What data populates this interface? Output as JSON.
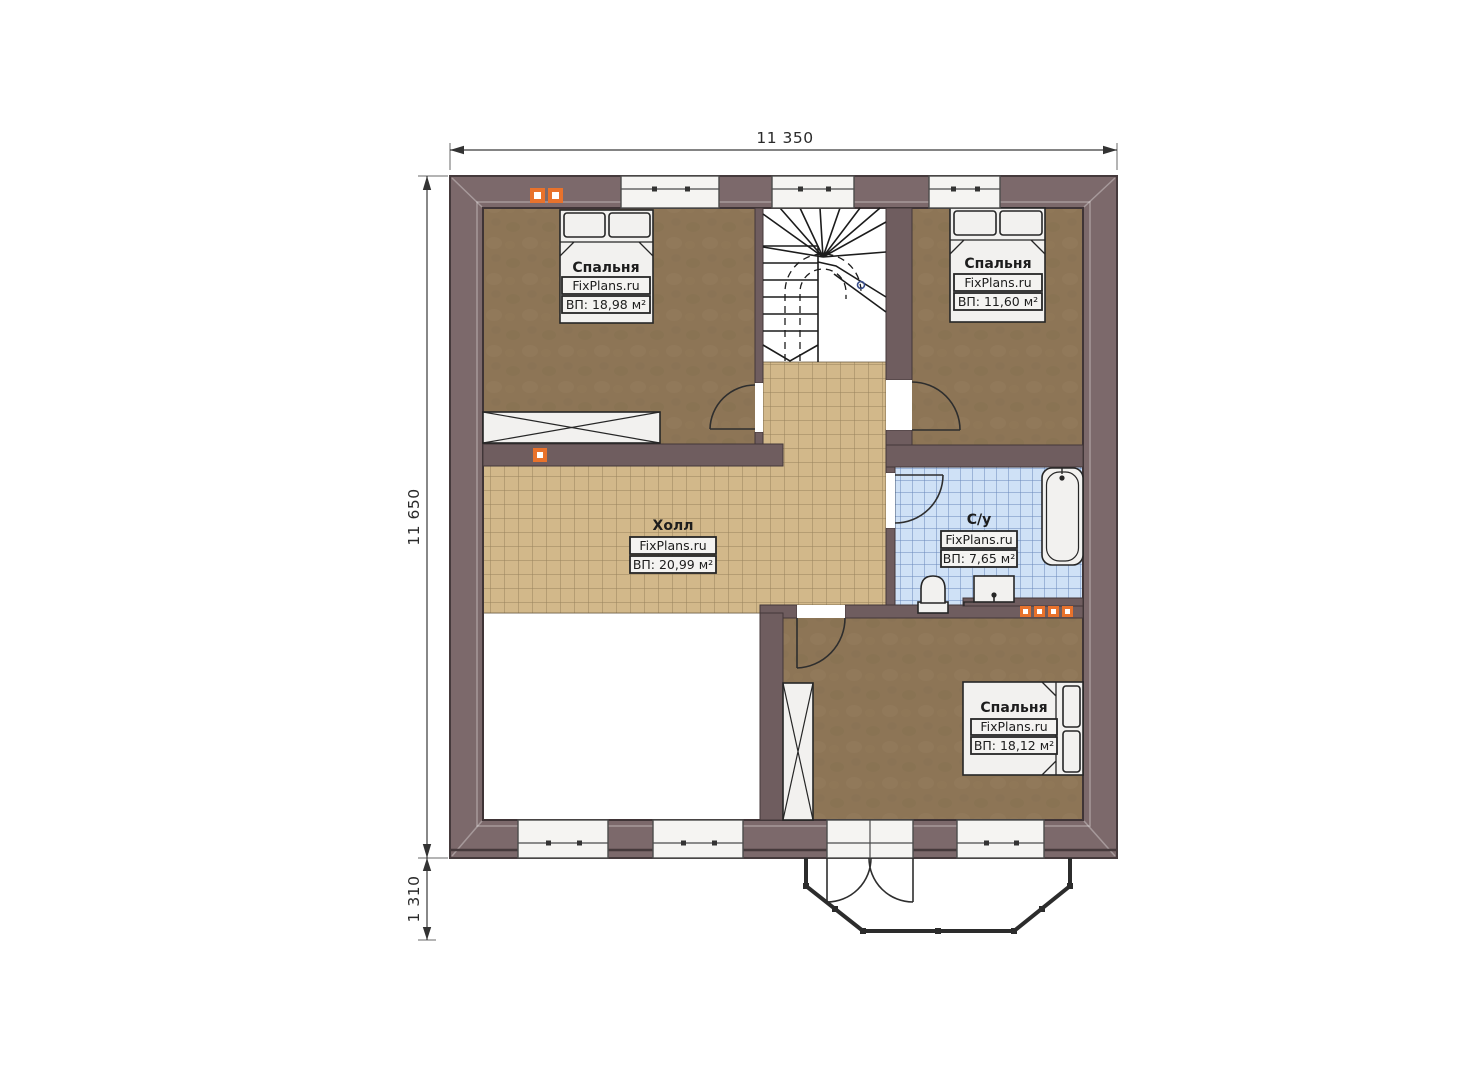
{
  "plan": {
    "brand": "FixPlans.ru",
    "dimensions": {
      "width_top": "11 350",
      "height_left": "11 650",
      "offset_bottom": "1 310"
    },
    "rooms": {
      "bedroom_top_left": {
        "name": "Спальня",
        "brand": "FixPlans.ru",
        "area": "ВП: 18,98 м²"
      },
      "bedroom_top_right": {
        "name": "Спальня",
        "brand": "FixPlans.ru",
        "area": "ВП: 11,60 м²"
      },
      "hall": {
        "name": "Холл",
        "brand": "FixPlans.ru",
        "area": "ВП: 20,99 м²"
      },
      "bathroom": {
        "name": "С/у",
        "brand": "FixPlans.ru",
        "area": "ВП: 7,65 м²"
      },
      "bedroom_bottom": {
        "name": "Спальня",
        "brand": "FixPlans.ru",
        "area": "ВП: 18,12 м²"
      }
    },
    "colors": {
      "wall_band": "#7c696b",
      "wall_inner": "#6f5d5f",
      "bedroom_floor": "#8d7556",
      "hall_tile": "#d2b88a",
      "bath_tile": "#cfe1f6",
      "accent_orange": "#e8722c",
      "fixture": "#f2f1ef"
    }
  }
}
